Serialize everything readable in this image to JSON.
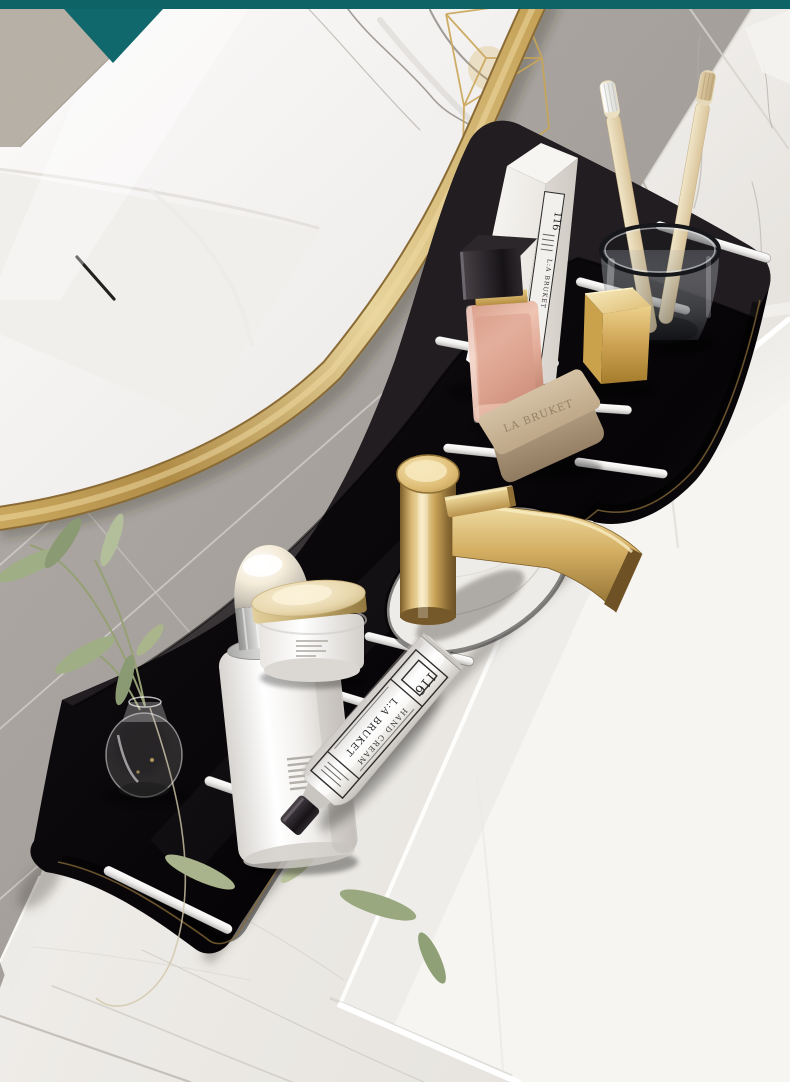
{
  "products": {
    "box_label_number": "116",
    "box_label_brand": "L:A BRUKET",
    "soap_embossed": "LA BRUKET",
    "tube_number": "116",
    "tube_product": "HAND CREAM",
    "tube_brand": "L:A BRUKET"
  },
  "palette": {
    "teal_banner": "#0f6468",
    "gold": "#c9a55c",
    "shelf_black": "#0d0a0d",
    "tile_gray": "#a39e99",
    "marble_white": "#f2f0ed",
    "counter": "#ece9e5",
    "sink_white": "#f7f6f3",
    "soap_beige": "#c9b497",
    "leaf_green": "#9cab80",
    "perfume_pink": "#e3b3a0",
    "bamboo_cream": "#e9dbb8"
  }
}
